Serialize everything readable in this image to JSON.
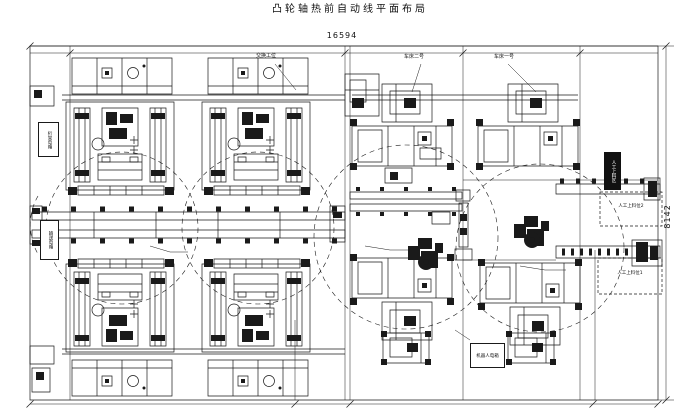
{
  "title": "凸轮轴热前自动线平面布局",
  "dimensions": {
    "top_width": "16594",
    "right_height": "8142"
  },
  "labels": {
    "exchange_station": "交换工位",
    "lathe_2": "车床二号",
    "lathe_1": "车床一号",
    "manual_load_area": "人工上料区",
    "manual_load_pos_2": "人工上料位2",
    "manual_load_pos_1": "人工上料位1",
    "robot_cabinet": "机器人电箱",
    "gantry_cabinet": "桁架电箱",
    "conveyor_cabinet": "输送电箱"
  },
  "colors": {
    "line": "#1a1a1a",
    "background": "#ffffff"
  }
}
